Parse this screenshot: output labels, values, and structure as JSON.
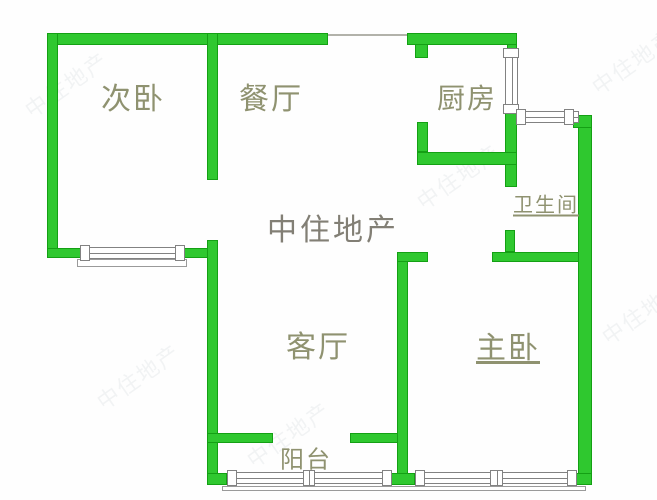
{
  "watermark": {
    "brand": "中住地产"
  },
  "rooms": [
    {
      "id": "secondary-bedroom",
      "label": "次卧"
    },
    {
      "id": "dining-room",
      "label": "餐厅"
    },
    {
      "id": "kitchen",
      "label": "厨房"
    },
    {
      "id": "bathroom",
      "label": "卫生间"
    },
    {
      "id": "living-room",
      "label": "客厅"
    },
    {
      "id": "master-bedroom",
      "label": "主卧"
    },
    {
      "id": "balcony",
      "label": "阳台"
    }
  ],
  "colors": {
    "wall_fill": "#2fc82f",
    "wall_border": "#14a014",
    "window_border": "#828282",
    "room_label": "#8f9270",
    "brand_watermark": "#6d695e",
    "background": "#ffffff"
  }
}
